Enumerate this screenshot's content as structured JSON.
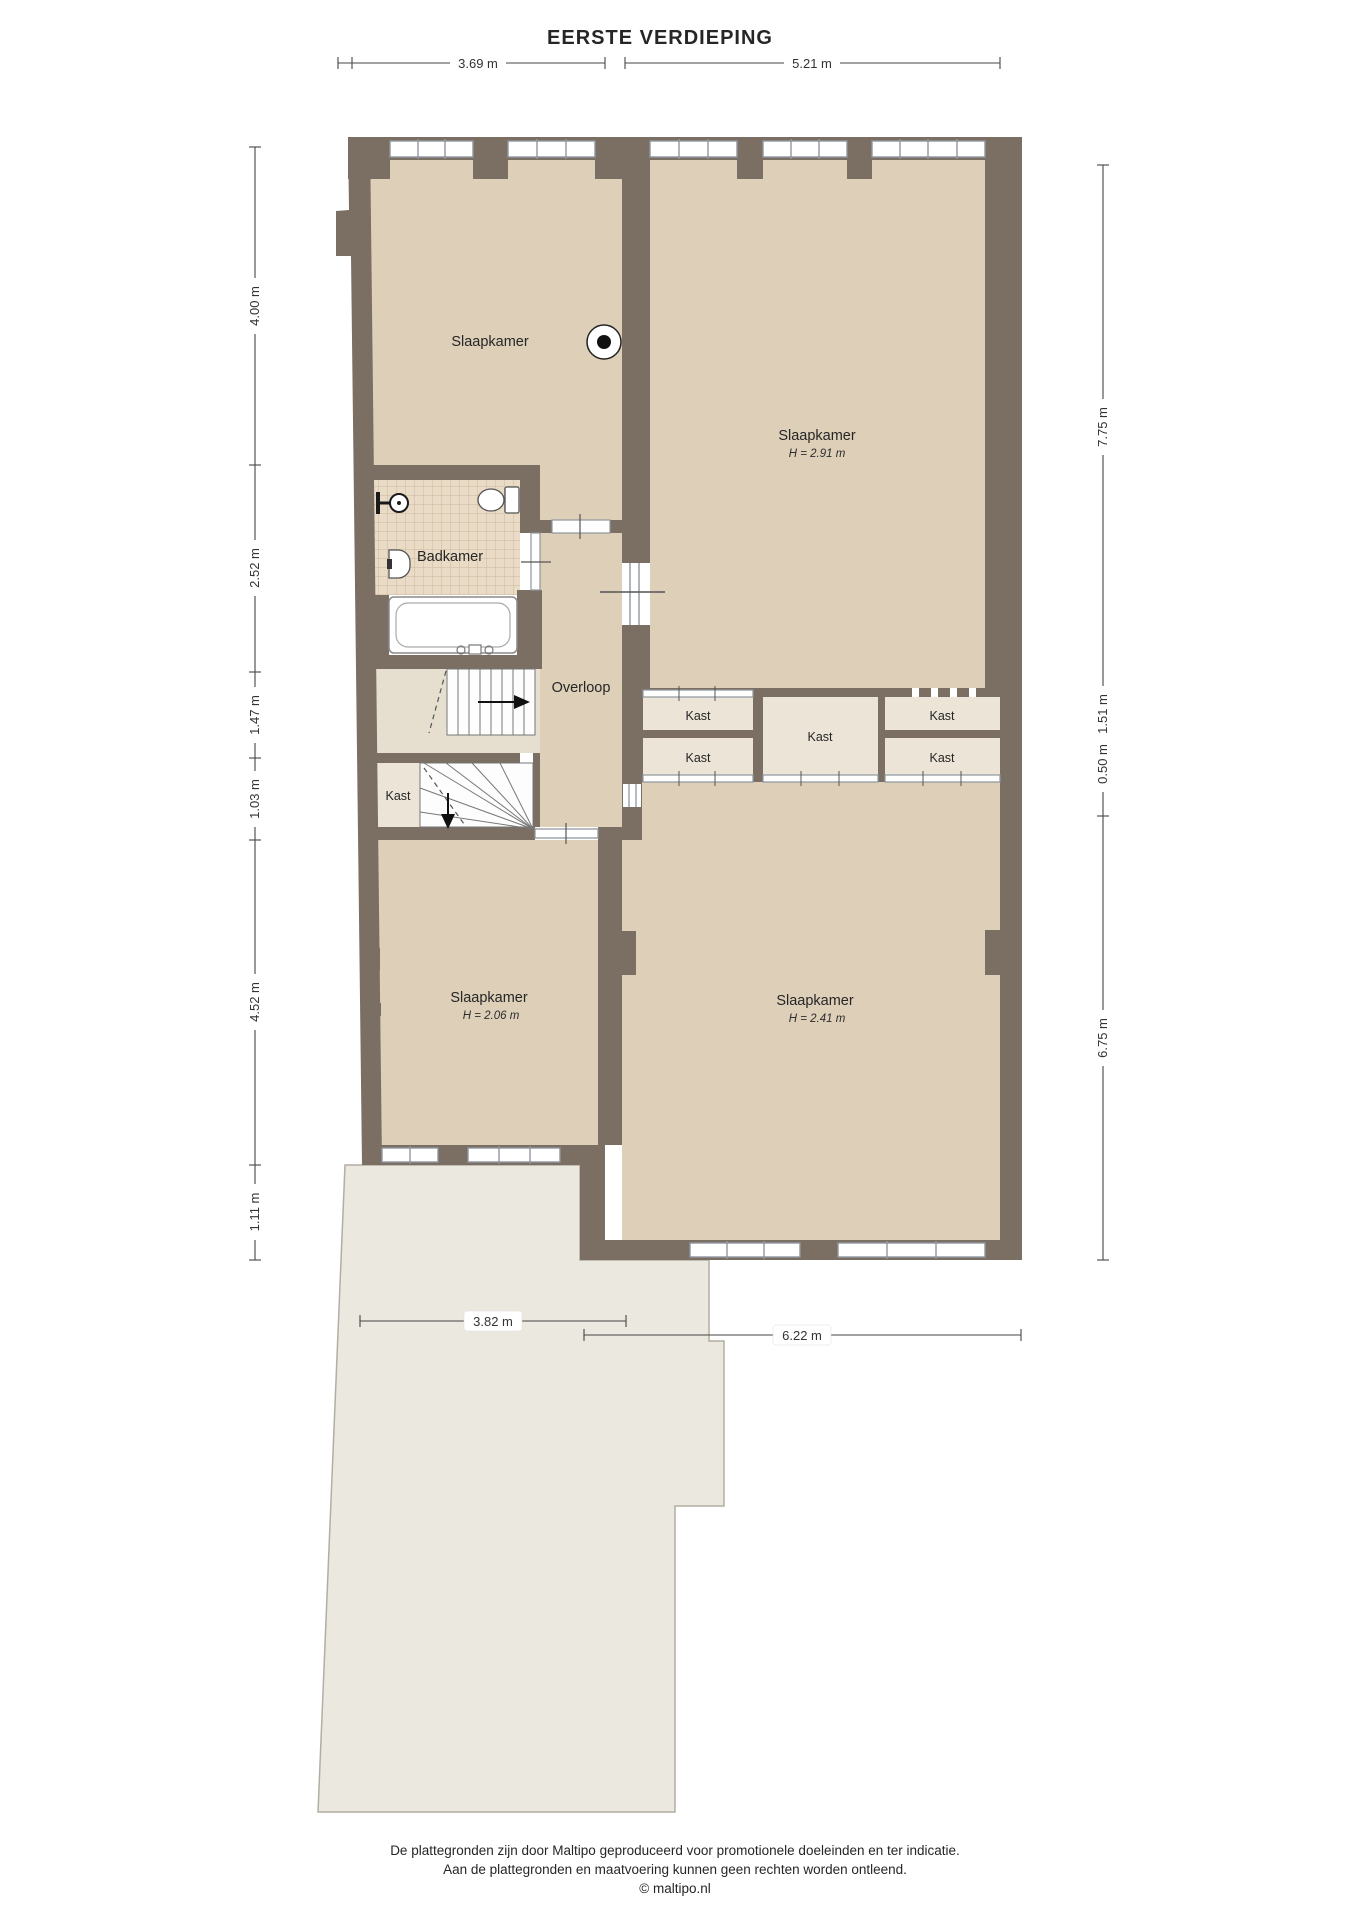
{
  "title": "EERSTE VERDIEPING",
  "dimensions": {
    "top": [
      "3.69 m",
      "5.21 m"
    ],
    "left": [
      "4.00 m",
      "2.52 m",
      "1.47 m",
      "1.03 m",
      "4.52 m",
      "1.11 m"
    ],
    "right": [
      "7.75 m",
      "1.51 m",
      "0.50 m",
      "6.75 m"
    ],
    "garden": [
      "3.82 m",
      "6.22 m"
    ]
  },
  "rooms": {
    "bedroom_top_left": {
      "label": "Slaapkamer"
    },
    "bedroom_top_right": {
      "label": "Slaapkamer",
      "height": "H = 2.91 m"
    },
    "bathroom": {
      "label": "Badkamer"
    },
    "landing": {
      "label": "Overloop"
    },
    "closet_stairs": {
      "label": "Kast"
    },
    "closet_row": [
      "Kast",
      "Kast",
      "Kast",
      "Kast",
      "Kast"
    ],
    "bedroom_bottom_left": {
      "label": "Slaapkamer",
      "height": "H = 2.06 m"
    },
    "bedroom_bottom_right": {
      "label": "Slaapkamer",
      "height": "H = 2.41 m"
    }
  },
  "footer": {
    "line1": "De plattegronden zijn door Maltipo geproduceerd voor promotionele doeleinden en ter indicatie.",
    "line2": "Aan de plattegronden en maatvoering kunnen geen rechten worden ontleend.",
    "line3": "© maltipo.nl"
  },
  "colors": {
    "wall": "#7b6e62",
    "floor": "#ddcfb8",
    "floor_light": "#e6dfd0",
    "closet_floor": "#ece5d7",
    "tile_base": "#e9dbc6",
    "tile_line": "#cdb89d",
    "garden": "#ebe8e0",
    "window_frame": "#8e979e",
    "dimension_line": "#454545"
  }
}
